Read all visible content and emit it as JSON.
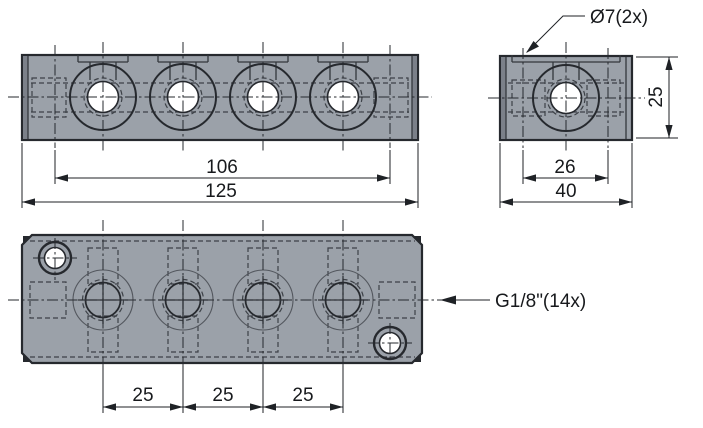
{
  "callouts": {
    "mount_hole": "Ø7(2x)",
    "port": "G1/8\"(14x)"
  },
  "dimensions": {
    "front_hole_span": "106",
    "front_width": "125",
    "side_port_spacing": "26",
    "side_depth": "40",
    "side_height": "25",
    "top_pitch_1": "25",
    "top_pitch_2": "25",
    "top_pitch_3": "25"
  },
  "colors": {
    "background": "#ffffff",
    "body_fill": "#9ba1a9",
    "edge_shade": "#7b8089",
    "outline": "#26292e",
    "dimension": "#1f2226"
  }
}
